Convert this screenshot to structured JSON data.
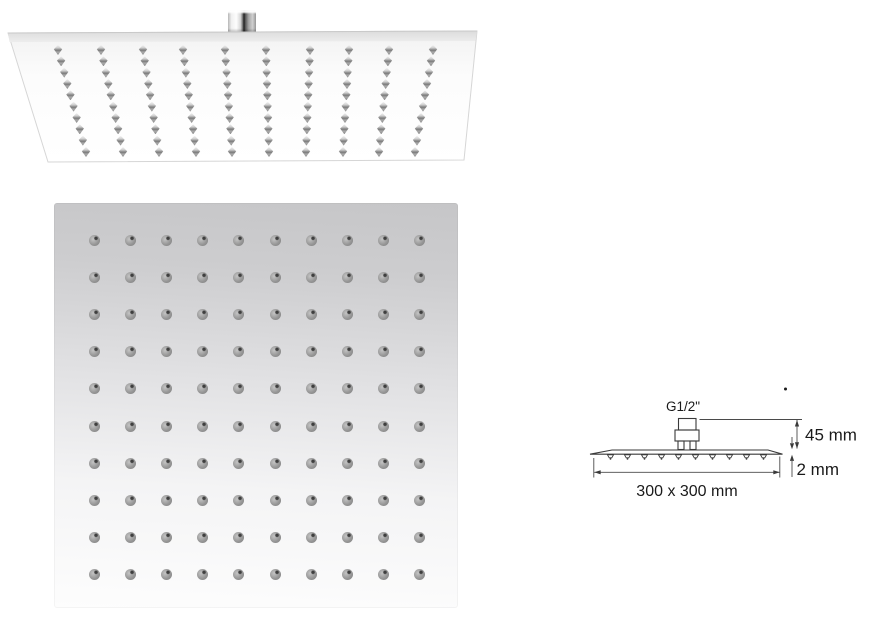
{
  "product": {
    "description": "Square ultra-thin rain shower head shown in perspective view, bottom spray-face view, and a dimensioned side-view drawing"
  },
  "perspective_view": {
    "grid": {
      "rows": 10,
      "cols": 10,
      "top_y": 50,
      "bottom_y": 152,
      "top_x": [
        58,
        101,
        143,
        183,
        225,
        266,
        310,
        349,
        389,
        433
      ],
      "bottom_x": [
        86,
        123,
        159,
        196,
        232,
        269,
        306,
        343,
        379,
        415
      ]
    }
  },
  "bottom_view": {
    "grid": {
      "rows": 10,
      "cols": 10,
      "start_x": 40,
      "start_y": 37,
      "spacing_x": 36.2,
      "spacing_y": 37.2
    }
  },
  "diagram": {
    "thread_label": "G1/2\"",
    "height_label": "45 mm",
    "thickness_label": "2 mm",
    "size_label": "300 x 300 mm",
    "side_nozzles": {
      "count": 10,
      "start_x": 610.5,
      "spacing": 17,
      "y_top": 454.8
    },
    "line_color": "#3a3a3a",
    "text_color": "#1a1a1a"
  },
  "colors": {
    "background": "#ffffff",
    "plate_gray_top": "#c6c6c8",
    "plate_white": "#fdfdfd",
    "nozzle_gray": "#8d8d8d",
    "chrome_dark": "#1d1d1d"
  }
}
